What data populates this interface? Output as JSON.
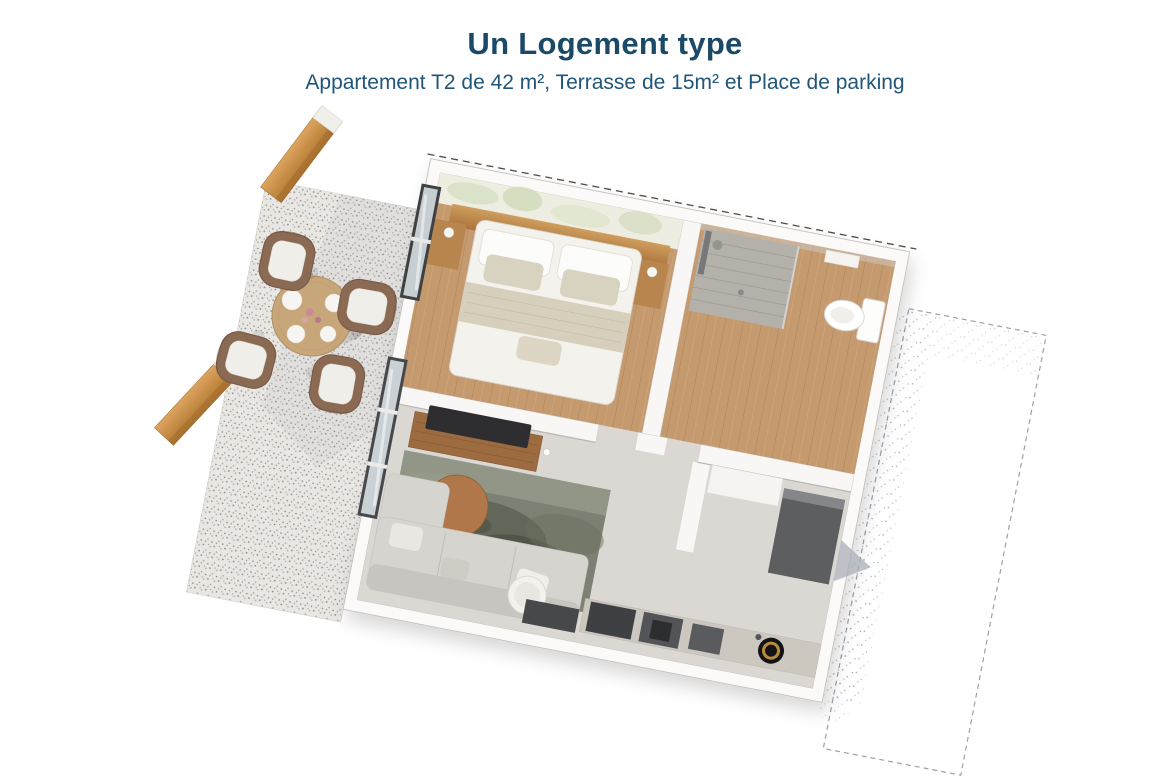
{
  "page": {
    "title": "Un Logement type",
    "subtitle": "Appartement T2 de 42 m², Terrasse de 15m² et Place de parking"
  },
  "colors": {
    "background": "#ffffff",
    "title_text": "#1b4a68",
    "subtitle_text": "#20567a",
    "wood_accent": "#c99354",
    "wood_floor": "#c49a6e",
    "terrace_concrete": "#e9e7e3",
    "interior_floor": "#dbd7d2",
    "wall_white": "#fbfaf8",
    "dark_appliance": "#46474a",
    "rug_green": "#777c6e"
  },
  "floor_plan": {
    "type": "3d-floor-plan",
    "areas": [
      "terrasse",
      "chambre",
      "salle-de-bain",
      "sejour",
      "cuisine",
      "place-de-parking"
    ]
  }
}
